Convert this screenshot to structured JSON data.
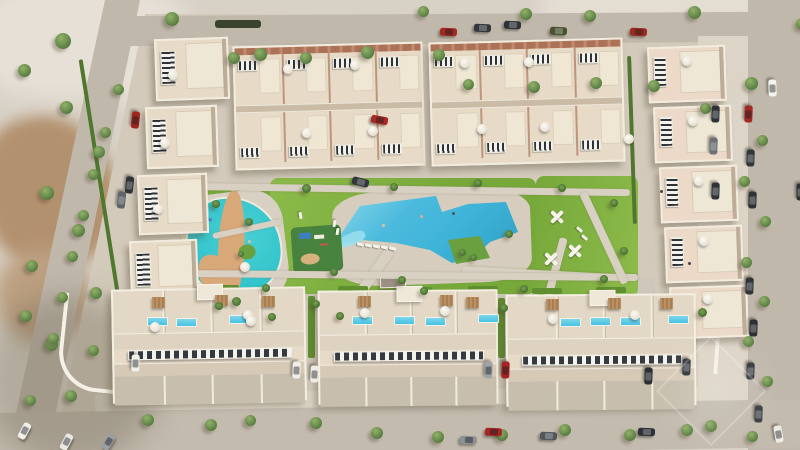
{
  "scene": {
    "type": "aerial-architectural-render",
    "description": "Top-down aerial 3D render of a beige Mediterranean residential complex: rows of townhouses with rooftop solar panels and terraces surround a central landscaped park containing a turquoise lagoon splash pool with a winding sand river, a large angular blue community pool with a planted island, lawns, white play structures and a playground. Perimeter roads with parked cars and trees; undeveloped sandy land at the edges.",
    "palette": {
      "sand": "#d8d1c6",
      "hard": "#d3cabb",
      "hardLight": "#dcd4c6",
      "road": "#c0b8ab",
      "bldg": "#e7dbc8",
      "bldgPink": "#ecd9c8",
      "brick": "#ac7258",
      "lawn": "#77a83a",
      "lawnLight": "#8cbb4a",
      "lawnDark": "#5f8f2e",
      "pool": "#3fb4d8",
      "poolBlue": "#45c2e4",
      "lagoon": "#2fc3ca",
      "river": "#d9a878",
      "island": "#6aa040",
      "tree": "#6d9150",
      "solarDark": "#2e3338",
      "playground": "#47823f"
    }
  },
  "objects": {
    "topBlocks": [
      [
        234,
        44,
        190,
        124,
        -1.5
      ],
      [
        430,
        40,
        194,
        124,
        -1.5
      ]
    ],
    "housesLeft": [
      [
        155,
        38,
        74,
        62,
        -2
      ],
      [
        146,
        106,
        72,
        62,
        -2
      ],
      [
        138,
        174,
        70,
        60,
        -2
      ],
      [
        130,
        240,
        68,
        56,
        -2
      ]
    ],
    "housesRight": [
      [
        648,
        46,
        78,
        56,
        -2
      ],
      [
        654,
        106,
        78,
        56,
        -2
      ],
      [
        660,
        166,
        78,
        56,
        -2
      ],
      [
        665,
        226,
        78,
        56,
        -2
      ],
      [
        670,
        286,
        78,
        52,
        -2
      ]
    ],
    "bottomBuildings": [
      [
        112,
        288,
        194,
        114,
        -1
      ],
      [
        318,
        290,
        180,
        114,
        -0.5
      ],
      [
        506,
        294,
        190,
        112,
        -0.5
      ]
    ],
    "paths": [
      [
        178,
        186,
        452,
        7,
        0.8
      ],
      [
        352,
        240,
        10,
        115,
        35
      ],
      [
        545,
        236,
        8,
        115,
        15
      ],
      [
        212,
        226,
        70,
        6,
        -12
      ],
      [
        462,
        270,
        150,
        7,
        3
      ],
      [
        178,
        272,
        460,
        7,
        0.5
      ],
      [
        600,
        188,
        8,
        100,
        -25
      ]
    ],
    "planters": [
      [
        205,
        285,
        34,
        6
      ],
      [
        268,
        287,
        30,
        6
      ],
      [
        338,
        286,
        30,
        6
      ],
      [
        402,
        287,
        30,
        6
      ],
      [
        468,
        286,
        30,
        6
      ],
      [
        532,
        288,
        30,
        6
      ],
      [
        596,
        287,
        30,
        6
      ],
      [
        308,
        296,
        7,
        62
      ],
      [
        498,
        298,
        7,
        60
      ]
    ],
    "hedges": [
      [
        97,
        58,
        4,
        235,
        -9,
        ""
      ],
      [
        630,
        56,
        4,
        168,
        -2,
        ""
      ],
      [
        215,
        20,
        46,
        8,
        0,
        "dark"
      ]
    ],
    "trees": [
      [
        55,
        33,
        16
      ],
      [
        18,
        64,
        13
      ],
      [
        60,
        101,
        13
      ],
      [
        93,
        146,
        12
      ],
      [
        40,
        186,
        14
      ],
      [
        72,
        224,
        13
      ],
      [
        26,
        260,
        12
      ],
      [
        90,
        287,
        12
      ],
      [
        45,
        338,
        13
      ],
      [
        88,
        345,
        11
      ],
      [
        20,
        310,
        12
      ],
      [
        65,
        390,
        12
      ],
      [
        25,
        395,
        11
      ],
      [
        113,
        84,
        11
      ],
      [
        100,
        127,
        11
      ],
      [
        88,
        169,
        11
      ],
      [
        78,
        210,
        11
      ],
      [
        67,
        251,
        11
      ],
      [
        57,
        292,
        11
      ],
      [
        48,
        333,
        11
      ],
      [
        165,
        12,
        14
      ],
      [
        228,
        52,
        12
      ],
      [
        254,
        48,
        13
      ],
      [
        300,
        52,
        12
      ],
      [
        361,
        46,
        13
      ],
      [
        433,
        49,
        12
      ],
      [
        463,
        79,
        11
      ],
      [
        528,
        81,
        12
      ],
      [
        590,
        77,
        12
      ],
      [
        648,
        80,
        12
      ],
      [
        520,
        8,
        12
      ],
      [
        584,
        10,
        12
      ],
      [
        418,
        6,
        11
      ],
      [
        688,
        6,
        13
      ],
      [
        745,
        77,
        13
      ],
      [
        757,
        135,
        11
      ],
      [
        739,
        176,
        11
      ],
      [
        760,
        216,
        11
      ],
      [
        741,
        257,
        11
      ],
      [
        759,
        296,
        11
      ],
      [
        743,
        336,
        11
      ],
      [
        762,
        376,
        11
      ],
      [
        705,
        420,
        12
      ],
      [
        747,
        431,
        11
      ],
      [
        700,
        103,
        11
      ],
      [
        796,
        18,
        12
      ],
      [
        302,
        184,
        9
      ],
      [
        390,
        183,
        8
      ],
      [
        474,
        179,
        8
      ],
      [
        558,
        184,
        8
      ],
      [
        610,
        199,
        8
      ],
      [
        232,
        297,
        9
      ],
      [
        262,
        284,
        8
      ],
      [
        330,
        268,
        8
      ],
      [
        398,
        276,
        8
      ],
      [
        420,
        287,
        8
      ],
      [
        336,
        312,
        8
      ],
      [
        268,
        313,
        8
      ],
      [
        620,
        247,
        8
      ],
      [
        600,
        275,
        8
      ],
      [
        520,
        285,
        8
      ],
      [
        212,
        200,
        8
      ],
      [
        245,
        218,
        8
      ],
      [
        505,
        230,
        8
      ],
      [
        459,
        249,
        7
      ],
      [
        470,
        254,
        7
      ],
      [
        238,
        251,
        6
      ],
      [
        142,
        414,
        12
      ],
      [
        205,
        419,
        12
      ],
      [
        245,
        415,
        11
      ],
      [
        310,
        417,
        12
      ],
      [
        371,
        427,
        12
      ],
      [
        432,
        431,
        12
      ],
      [
        496,
        429,
        12
      ],
      [
        559,
        424,
        12
      ],
      [
        624,
        429,
        12
      ],
      [
        681,
        424,
        12
      ],
      [
        215,
        302,
        8
      ],
      [
        312,
        300,
        8
      ],
      [
        500,
        304,
        8
      ],
      [
        698,
        308,
        9
      ]
    ],
    "cars": [
      [
        440,
        28,
        2,
        "#a5291f"
      ],
      [
        474,
        24,
        2,
        "#33373c"
      ],
      [
        504,
        21,
        2,
        "#2f3338"
      ],
      [
        550,
        27,
        2,
        "#49522f"
      ],
      [
        630,
        28,
        2,
        "#9e2a1e"
      ],
      [
        764,
        84,
        88,
        "#f4f3ef"
      ],
      [
        740,
        110,
        92,
        "#a02b24"
      ],
      [
        707,
        110,
        92,
        "#2f3338"
      ],
      [
        742,
        154,
        92,
        "#33373c"
      ],
      [
        705,
        142,
        92,
        "#6d7176"
      ],
      [
        744,
        196,
        92,
        "#2f3338"
      ],
      [
        707,
        187,
        92,
        "#303439"
      ],
      [
        741,
        282,
        92,
        "#303439"
      ],
      [
        745,
        324,
        92,
        "#2c3034"
      ],
      [
        742,
        367,
        92,
        "#34383d"
      ],
      [
        750,
        410,
        92,
        "#3a3e43"
      ],
      [
        770,
        430,
        80,
        "#edebe6"
      ],
      [
        792,
        188,
        90,
        "#2e3237"
      ],
      [
        127,
        116,
        96,
        "#a1251f"
      ],
      [
        121,
        181,
        96,
        "#2f3338"
      ],
      [
        113,
        196,
        96,
        "#606468"
      ],
      [
        371,
        116,
        10,
        "#a82a22"
      ],
      [
        352,
        178,
        14,
        "#33373b"
      ],
      [
        127,
        359,
        92,
        "#f2f0ea"
      ],
      [
        288,
        366,
        92,
        "#f1efe9"
      ],
      [
        306,
        370,
        92,
        "#eeece6"
      ],
      [
        480,
        366,
        92,
        "#9fa3a8"
      ],
      [
        497,
        366,
        92,
        "#a52320"
      ],
      [
        678,
        363,
        92,
        "#2e3237"
      ],
      [
        640,
        372,
        92,
        "#2b2f34"
      ],
      [
        16,
        427,
        -62,
        "#f1efe9"
      ],
      [
        58,
        438,
        -62,
        "#ebe9e3"
      ],
      [
        100,
        438,
        -58,
        "#9b9fa3"
      ],
      [
        485,
        428,
        2,
        "#a52620"
      ],
      [
        460,
        436,
        2,
        "#8d9195"
      ],
      [
        638,
        428,
        2,
        "#2d3135"
      ],
      [
        540,
        432,
        2,
        "#52565b"
      ]
    ],
    "parasols": [
      [
        168,
        70
      ],
      [
        160,
        138
      ],
      [
        153,
        204
      ],
      [
        283,
        64
      ],
      [
        350,
        60
      ],
      [
        460,
        58
      ],
      [
        524,
        57
      ],
      [
        302,
        128
      ],
      [
        368,
        126
      ],
      [
        477,
        124
      ],
      [
        540,
        122
      ],
      [
        682,
        56
      ],
      [
        688,
        116
      ],
      [
        694,
        176
      ],
      [
        699,
        236
      ],
      [
        703,
        294
      ],
      [
        150,
        322
      ],
      [
        243,
        310
      ],
      [
        360,
        308
      ],
      [
        440,
        306
      ],
      [
        548,
        314
      ],
      [
        630,
        310
      ],
      [
        240,
        262
      ],
      [
        624,
        134
      ],
      [
        246,
        316
      ]
    ],
    "roofPools": [
      [
        147,
        317
      ],
      [
        176,
        318
      ],
      [
        229,
        315
      ],
      [
        352,
        316
      ],
      [
        394,
        316
      ],
      [
        425,
        317
      ],
      [
        478,
        314
      ],
      [
        560,
        318
      ],
      [
        590,
        317
      ],
      [
        620,
        317
      ],
      [
        668,
        315
      ]
    ],
    "pergolas": [
      [
        152,
        297
      ],
      [
        215,
        295
      ],
      [
        262,
        296
      ],
      [
        358,
        296
      ],
      [
        440,
        295
      ],
      [
        466,
        297
      ],
      [
        546,
        299
      ],
      [
        608,
        298
      ],
      [
        660,
        298
      ]
    ],
    "xplays": [
      [
        548,
        208
      ],
      [
        566,
        242
      ],
      [
        542,
        250
      ]
    ],
    "loungers": [
      [
        357,
        243,
        14
      ],
      [
        365,
        244,
        14
      ],
      [
        373,
        245,
        14
      ],
      [
        381,
        246,
        14
      ],
      [
        389,
        247,
        14
      ],
      [
        331,
        222,
        100
      ],
      [
        334,
        230,
        100
      ],
      [
        576,
        228,
        40
      ],
      [
        581,
        236,
        40
      ],
      [
        297,
        214,
        80
      ]
    ],
    "specks": [
      [
        420,
        215,
        "#d8b08c"
      ],
      [
        452,
        212,
        "#3d5a66"
      ],
      [
        382,
        224,
        "#e0c0a0"
      ],
      [
        660,
        190,
        "#44484e"
      ],
      [
        688,
        262,
        "#44484e"
      ],
      [
        248,
        240,
        "#e0c0a0"
      ]
    ]
  }
}
